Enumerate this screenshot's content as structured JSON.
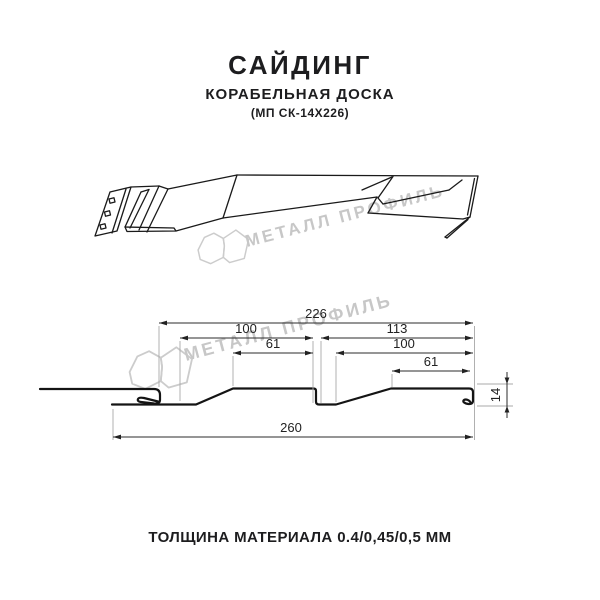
{
  "header": {
    "title": "САЙДИНГ",
    "subtitle": "КОРАБЕЛЬНАЯ ДОСКА",
    "code": "(МП СК-14Х226)"
  },
  "watermark": {
    "text": "МЕТАЛЛ ПРОФИЛЬ",
    "color": "#c7c7c7"
  },
  "dimensions": {
    "overall_width": "226",
    "left_panel_width": "100",
    "right_panel_width": "113",
    "left_flat_width": "61",
    "right_panel_inner": "100",
    "right_flat_width": "61",
    "total_length": "260",
    "profile_height": "14"
  },
  "footer": {
    "thickness_label": "ТОЛЩИНА МАТЕРИАЛА 0.4/0,45/0,5 ММ"
  },
  "colors": {
    "line": "#1a1a1a",
    "dimension": "#222222",
    "extension": "#a8a8a8",
    "watermark": "#c7c7c7",
    "background": "#ffffff"
  }
}
